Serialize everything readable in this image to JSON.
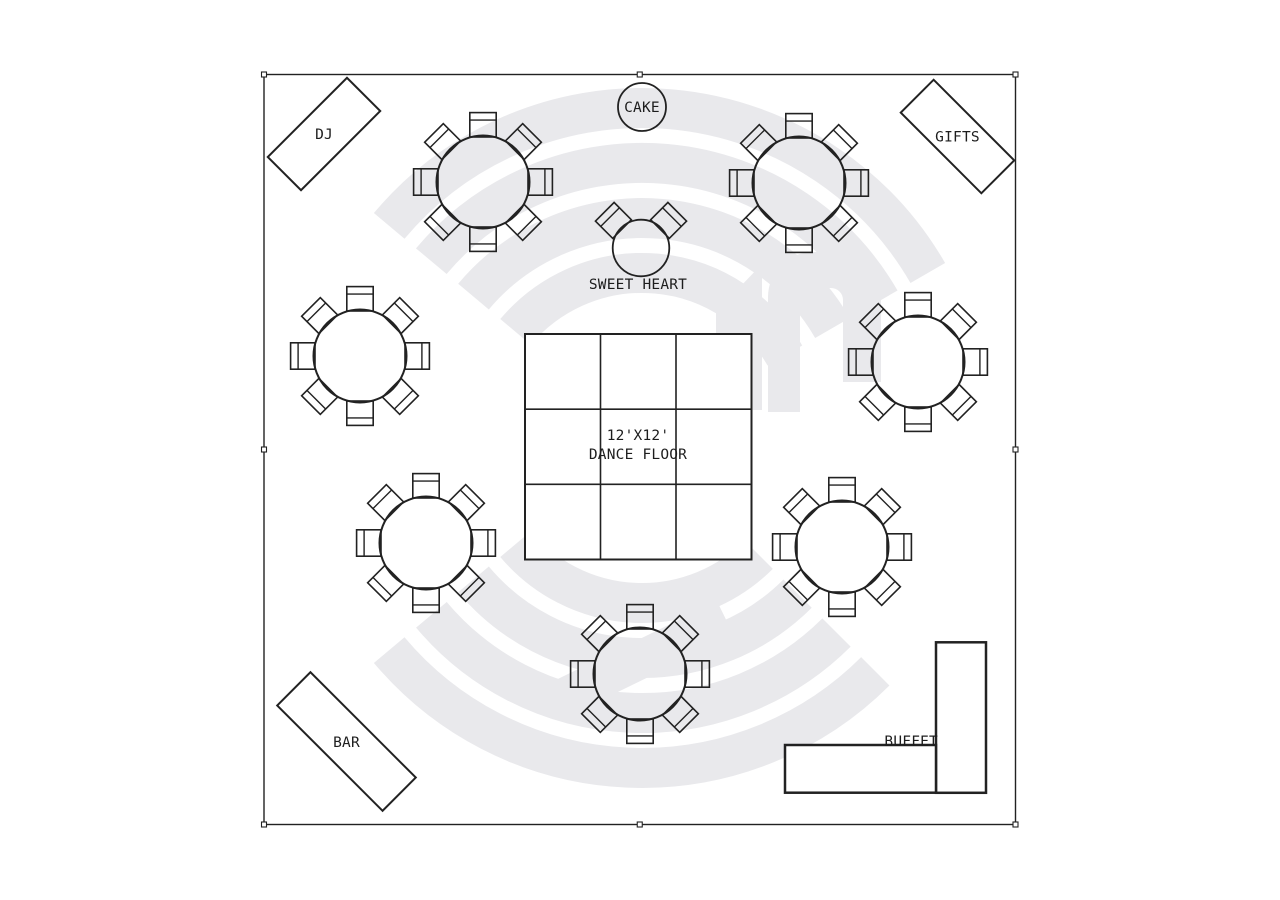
{
  "floor_plan": {
    "colors": {
      "line": "#222222",
      "label": "#1d1d1d",
      "watermark": "#e9e9ec",
      "background": "#ffffff"
    },
    "boundary": {
      "x": 264,
      "y": 74.5,
      "width": 751.5,
      "height": 750,
      "handle_size": 5
    },
    "chair": {
      "width": 26.4,
      "height": 24.4,
      "back_offset": 7.5
    },
    "seat_angles_8": [
      0,
      45,
      90,
      135,
      180,
      225,
      270,
      315
    ],
    "guest_tables": [
      {
        "name": "guest-table-1",
        "cx": 483,
        "cy": 182,
        "radius": 46.5,
        "seats": 8
      },
      {
        "name": "guest-table-2",
        "cx": 799,
        "cy": 183,
        "radius": 46.5,
        "seats": 8
      },
      {
        "name": "guest-table-3",
        "cx": 360,
        "cy": 356,
        "radius": 46.5,
        "seats": 8
      },
      {
        "name": "guest-table-4",
        "cx": 918,
        "cy": 362,
        "radius": 46.5,
        "seats": 8
      },
      {
        "name": "guest-table-5",
        "cx": 426,
        "cy": 543,
        "radius": 46.5,
        "seats": 8
      },
      {
        "name": "guest-table-6",
        "cx": 842,
        "cy": 547,
        "radius": 46.5,
        "seats": 8
      },
      {
        "name": "guest-table-7",
        "cx": 640,
        "cy": 674,
        "radius": 46.5,
        "seats": 8
      }
    ],
    "stations": {
      "dj": {
        "label": "DJ",
        "cx": 324,
        "cy": 134,
        "length": 112,
        "depth": 47,
        "rotation": -45
      },
      "gifts": {
        "label": "GIFTS",
        "cx": 957.5,
        "cy": 136.5,
        "length": 114,
        "depth": 46.5,
        "rotation": 45
      },
      "bar": {
        "label": "BAR",
        "cx": 346.5,
        "cy": 741.5,
        "length": 149,
        "depth": 47,
        "rotation": 45
      },
      "cake": {
        "label": "CAKE",
        "cx": 642,
        "cy": 107,
        "radius": 24
      },
      "sweetheart": {
        "label": "SWEET HEART",
        "cx": 641,
        "cy": 248,
        "radius": 28.3,
        "seats": 2,
        "seat_angles": [
          -45,
          45
        ]
      },
      "buffet": {
        "label": "BUFFET",
        "segments": [
          {
            "x": 936,
            "y": 642.3,
            "width": 50,
            "height": 150.5
          },
          {
            "x": 785,
            "y": 745,
            "width": 151,
            "height": 47.7
          }
        ]
      },
      "dance_floor": {
        "label_line1": "12'X12'",
        "label_line2": "DANCE FLOOR",
        "x": 525,
        "y": 334,
        "width": 226.5,
        "height": 225.5,
        "grid_rows": 3,
        "grid_cols": 3
      }
    }
  }
}
